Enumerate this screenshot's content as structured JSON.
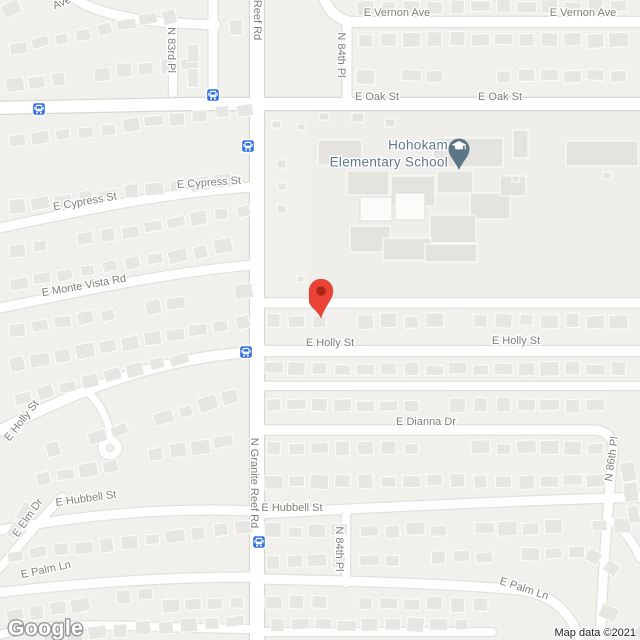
{
  "map": {
    "logo": "Google",
    "attribution": "Map data ©2021",
    "colors": {
      "land": "#f1f0ed",
      "school_ground": "#efeeea",
      "road": "#ffffff",
      "road_casing": "#e2e0db",
      "major_casing": "#d9d7d2",
      "house": "#e7e6e2",
      "school_building": "#e4e3df",
      "street_label": "#807e79",
      "poi_label": "#5f7889",
      "marker_red": "#EA4335",
      "marker_inner": "#971B0E",
      "school_pin": "#5b7584",
      "bus_blue": "#2F6FE3",
      "attribution_text": "#202124"
    },
    "poi": {
      "line1": "Hohokam",
      "line2": "Elementary School",
      "text_right_x": 448,
      "line1_y": 146,
      "line2_y": 163,
      "pin_x": 459,
      "pin_y": 149
    },
    "marker": {
      "x": 321,
      "y": 291,
      "tip_y": 318
    },
    "bus_stops": [
      {
        "x": 213,
        "y": 95
      },
      {
        "x": 39,
        "y": 109
      },
      {
        "x": 248,
        "y": 146
      },
      {
        "x": 246,
        "y": 352
      },
      {
        "x": 259,
        "y": 542
      }
    ],
    "street_labels": [
      {
        "id": "vernon-ave-partial",
        "text": "Ave",
        "x": 62,
        "y": 3,
        "rotate": -24
      },
      {
        "id": "vernon-ave-1",
        "text": "E Vernon Ave",
        "x": 397,
        "y": 13,
        "rotate": 0
      },
      {
        "id": "vernon-ave-2",
        "text": "E Vernon Ave",
        "x": 583,
        "y": 13,
        "rotate": 0
      },
      {
        "id": "reef-rd-top",
        "text": "Reef Rd",
        "x": 257,
        "y": 20,
        "rotate": 90
      },
      {
        "id": "n-83rd-pl",
        "text": "N 83rd Pl",
        "x": 171,
        "y": 50,
        "rotate": 90
      },
      {
        "id": "n-84th-pl-top",
        "text": "N 84th Pl",
        "x": 341,
        "y": 55,
        "rotate": 90
      },
      {
        "id": "oak-st-1",
        "text": "E Oak St",
        "x": 377,
        "y": 97,
        "rotate": 0
      },
      {
        "id": "oak-st-2",
        "text": "E Oak St",
        "x": 500,
        "y": 97,
        "rotate": 0
      },
      {
        "id": "cypress-st-w",
        "text": "E Cypress St",
        "x": 85,
        "y": 202,
        "rotate": -10
      },
      {
        "id": "cypress-st-e",
        "text": "E Cypress St",
        "x": 209,
        "y": 183,
        "rotate": -4
      },
      {
        "id": "monte-vista-rd",
        "text": "E Monte Vista Rd",
        "x": 84,
        "y": 286,
        "rotate": -10
      },
      {
        "id": "holly-st-e1",
        "text": "E Holly St",
        "x": 330,
        "y": 343,
        "rotate": 0
      },
      {
        "id": "holly-st-e2",
        "text": "E Holly St",
        "x": 516,
        "y": 341,
        "rotate": 0
      },
      {
        "id": "holly-st-w",
        "text": "E Holly St",
        "x": 22,
        "y": 421,
        "rotate": -52
      },
      {
        "id": "dianna-dr",
        "text": "E Dianna Dr",
        "x": 426,
        "y": 422,
        "rotate": 0
      },
      {
        "id": "n-86th-pl",
        "text": "N 86th Pl",
        "x": 612,
        "y": 459,
        "rotate": -82
      },
      {
        "id": "granite-reef-rd",
        "text": "N Granite Reef Rd",
        "x": 254,
        "y": 483,
        "rotate": 90
      },
      {
        "id": "hubbell-st-w",
        "text": "E Hubbell St",
        "x": 86,
        "y": 499,
        "rotate": -8
      },
      {
        "id": "hubbell-st-e",
        "text": "E Hubbell St",
        "x": 292,
        "y": 508,
        "rotate": 0
      },
      {
        "id": "elm-dr",
        "text": "E Elm Dr",
        "x": 28,
        "y": 518,
        "rotate": -55
      },
      {
        "id": "palm-ln-w",
        "text": "E Palm Ln",
        "x": 46,
        "y": 570,
        "rotate": -12
      },
      {
        "id": "palm-ln-e",
        "text": "E Palm Ln",
        "x": 524,
        "y": 589,
        "rotate": 18
      },
      {
        "id": "n-84th-pl-bottom",
        "text": "N 84th Pl",
        "x": 339,
        "y": 549,
        "rotate": 90
      }
    ]
  }
}
